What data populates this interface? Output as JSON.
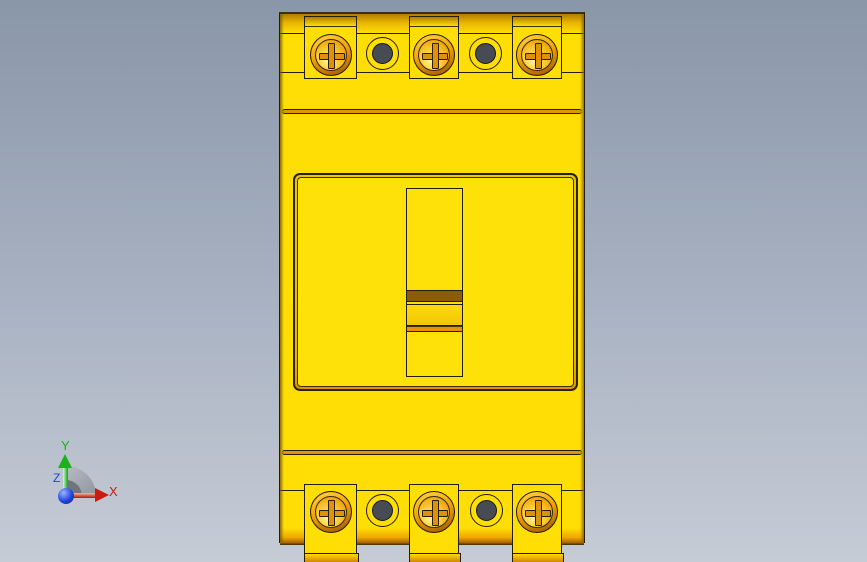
{
  "viewport": {
    "kind": "cad-3d-view",
    "content": "yellow molded-case circuit breaker, front view"
  },
  "model": {
    "name": "circuit-breaker",
    "pole_count": 3,
    "top_terminal_screws": 3,
    "bottom_terminal_screws": 3,
    "top_wire_holes": 2,
    "bottom_wire_holes": 2,
    "toggle_position": "center"
  },
  "axis_triad": {
    "x_label": "X",
    "y_label": "Y",
    "z_label": "Z"
  },
  "css_vars": {
    "bg-top": "#8a96a9",
    "bg-mid": "#a6b0c0",
    "bg-bottom": "#c6ccd6",
    "body-yellow": "#ffde06",
    "panel-yellow": "#ffe10a",
    "outline": "#241e00",
    "amber-dark": "#b07c00",
    "orange-band": "#e8920c",
    "brown-band": "#8a5c08",
    "handle-yellow": "#ffdb08",
    "ring-light": "#ffc833",
    "ring-dark": "#aa6000",
    "screw-hi": "#fff2b8",
    "cross-fill": "#e09206",
    "hole-dark": "#474c54",
    "axis-red": "#cc1a10",
    "axis-green": "#1ab11a",
    "axis-blue": "#2244cc",
    "pie-light": "#b8bdc4",
    "pie-dark": "#6f757d"
  }
}
